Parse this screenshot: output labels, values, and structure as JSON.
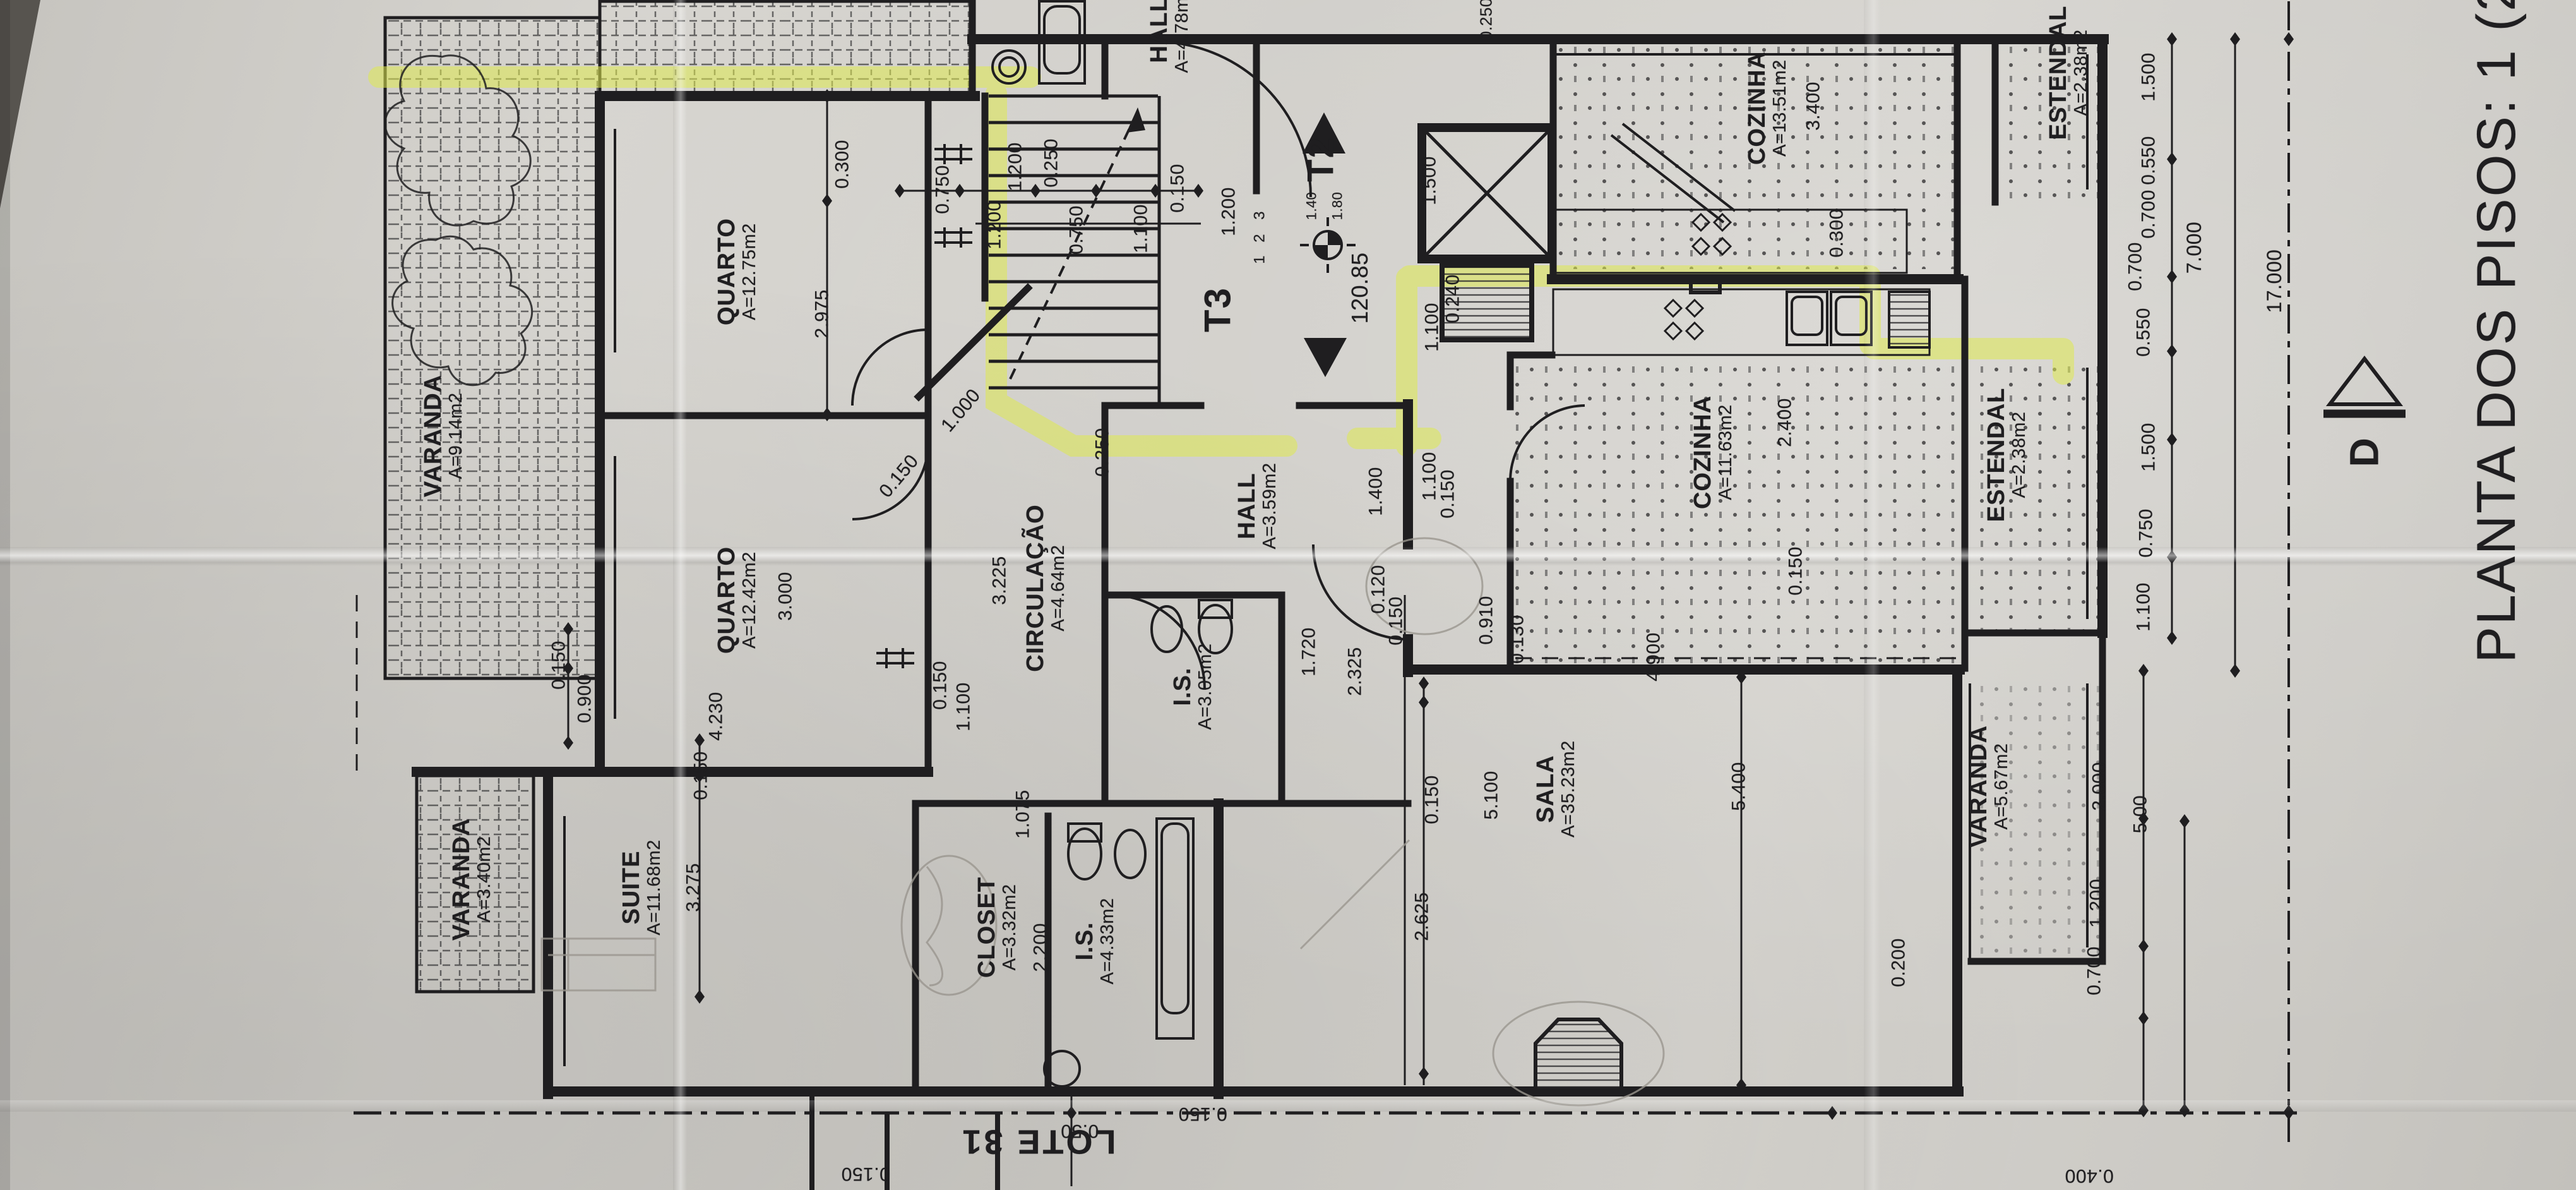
{
  "title": "PLANTA DOS PISOS: 1 (2, 3",
  "lot_label": "LOTE 31",
  "section_marker": "D",
  "levels": {
    "t2": "T2",
    "t3": "T3",
    "elevation": "120.85"
  },
  "stair_steps": [
    {
      "t": "3",
      "x": 48.9,
      "y": 18.1
    },
    {
      "t": "2",
      "x": 48.9,
      "y": 20.0
    },
    {
      "t": "1",
      "x": 48.9,
      "y": 21.8
    }
  ],
  "rooms": [
    {
      "n": "VARANDA",
      "a": "A=9.14m2",
      "x": 17.2,
      "y": 36.6
    },
    {
      "n": "QUARTO",
      "a": "A=12.75m2",
      "x": 28.6,
      "y": 22.8
    },
    {
      "n": "QUARTO",
      "a": "A=12.42m2",
      "x": 28.6,
      "y": 50.4
    },
    {
      "n": "CIRCULAÇÃO",
      "a": "A=4.64m2",
      "x": 40.6,
      "y": 49.4
    },
    {
      "n": "HALL",
      "a": "A=3.59m2",
      "x": 48.8,
      "y": 42.5
    },
    {
      "n": "HALL",
      "a": "A=4.78m2",
      "x": 45.4,
      "y": 2.5
    },
    {
      "n": "COZINHA",
      "a": "A=13.51m2",
      "x": 68.6,
      "y": 9.1
    },
    {
      "n": "COZINHA",
      "a": "A=11.63m2",
      "x": 66.5,
      "y": 38.0
    },
    {
      "n": "ESTENDAL",
      "a": "A=2.38m2",
      "x": 80.3,
      "y": 6.1
    },
    {
      "n": "ESTENDAL",
      "a": "A=2.38m2",
      "x": 77.9,
      "y": 38.2
    },
    {
      "n": "SALA",
      "a": "A=35.23m2",
      "x": 60.4,
      "y": 66.3
    },
    {
      "n": "VARANDA",
      "a": "A=5.67m2",
      "x": 77.2,
      "y": 66.1
    },
    {
      "n": "VARANDA",
      "a": "A=3.40m2",
      "x": 18.3,
      "y": 73.9
    },
    {
      "n": "SUITE",
      "a": "A=11.68m2",
      "x": 24.9,
      "y": 74.6
    },
    {
      "n": "CLOSET",
      "a": "A=3.32m2",
      "x": 38.7,
      "y": 77.9
    },
    {
      "n": "I.S.",
      "a": "A=4.33m2",
      "x": 42.5,
      "y": 79.1
    },
    {
      "n": "I.S.",
      "a": "A=3.05m2",
      "x": 46.3,
      "y": 57.7
    }
  ],
  "dims": [
    {
      "t": "0.300",
      "x": 32.7,
      "y": 13.8
    },
    {
      "t": "2.975",
      "x": 31.9,
      "y": 26.4
    },
    {
      "t": "0.750",
      "x": 36.6,
      "y": 15.9
    },
    {
      "t": "1.200",
      "x": 39.4,
      "y": 14.0
    },
    {
      "t": "0.250",
      "x": 40.8,
      "y": 13.7
    },
    {
      "t": "0.150",
      "x": 45.7,
      "y": 15.8
    },
    {
      "t": "1.200",
      "x": 47.7,
      "y": 17.8
    },
    {
      "t": "1.200",
      "x": 38.6,
      "y": 18.9
    },
    {
      "t": "0.750",
      "x": 41.8,
      "y": 19.3
    },
    {
      "t": "1.100",
      "x": 44.3,
      "y": 19.2
    },
    {
      "t": "1.500",
      "x": 55.5,
      "y": 15.2
    },
    {
      "t": "1.40",
      "x": 50.9,
      "y": 17.3,
      "s": 22
    },
    {
      "t": "1.80",
      "x": 51.9,
      "y": 17.3,
      "s": 22
    },
    {
      "t": "0.240",
      "x": 56.4,
      "y": 25.1
    },
    {
      "t": "1.100",
      "x": 55.6,
      "y": 27.5
    },
    {
      "t": "0.250",
      "x": 57.7,
      "y": 1.6,
      "s": 26
    },
    {
      "t": "3.400",
      "x": 70.4,
      "y": 8.9
    },
    {
      "t": "0.300",
      "x": 71.3,
      "y": 19.6
    },
    {
      "t": "2.400",
      "x": 69.3,
      "y": 35.5
    },
    {
      "t": "0.150",
      "x": 69.7,
      "y": 48.0
    },
    {
      "t": "4.900",
      "x": 64.2,
      "y": 55.2
    },
    {
      "t": "1.500",
      "x": 83.4,
      "y": 6.5
    },
    {
      "t": "0.550",
      "x": 83.4,
      "y": 13.5
    },
    {
      "t": "0.700",
      "x": 83.4,
      "y": 18.0
    },
    {
      "t": "0.700",
      "x": 82.9,
      "y": 22.4
    },
    {
      "t": "0.550",
      "x": 83.2,
      "y": 27.9
    },
    {
      "t": "7.000",
      "x": 85.2,
      "y": 20.8,
      "s": 32
    },
    {
      "t": "17.000",
      "x": 88.3,
      "y": 23.6,
      "s": 32
    },
    {
      "t": "1.500",
      "x": 83.4,
      "y": 37.6
    },
    {
      "t": "0.750",
      "x": 83.3,
      "y": 44.8
    },
    {
      "t": "1.100",
      "x": 83.2,
      "y": 51.0
    },
    {
      "t": "3.000",
      "x": 30.5,
      "y": 50.1
    },
    {
      "t": "4.230",
      "x": 27.8,
      "y": 60.2
    },
    {
      "t": "0.150",
      "x": 36.5,
      "y": 57.6
    },
    {
      "t": "1.100",
      "x": 37.4,
      "y": 59.4
    },
    {
      "t": "3.225",
      "x": 38.8,
      "y": 48.8
    },
    {
      "t": "1.000",
      "x": 37.3,
      "y": 34.5,
      "r": -50
    },
    {
      "t": "0.150",
      "x": 34.9,
      "y": 40.0,
      "r": -50
    },
    {
      "t": "0.250",
      "x": 42.8,
      "y": 38.0
    },
    {
      "t": "1.400",
      "x": 53.4,
      "y": 41.3
    },
    {
      "t": "1.100",
      "x": 55.5,
      "y": 40.0
    },
    {
      "t": "0.150",
      "x": 56.2,
      "y": 41.5
    },
    {
      "t": "0.120",
      "x": 53.5,
      "y": 49.5
    },
    {
      "t": "0.150",
      "x": 54.2,
      "y": 52.2
    },
    {
      "t": "0.910",
      "x": 57.7,
      "y": 52.1
    },
    {
      "t": "0.130",
      "x": 58.9,
      "y": 53.7
    },
    {
      "t": "1.720",
      "x": 50.8,
      "y": 54.8
    },
    {
      "t": "2.325",
      "x": 52.6,
      "y": 56.4
    },
    {
      "t": "2.625",
      "x": 55.2,
      "y": 77.0
    },
    {
      "t": "0.150",
      "x": 55.6,
      "y": 67.2
    },
    {
      "t": "5.100",
      "x": 57.9,
      "y": 66.8
    },
    {
      "t": "5.400",
      "x": 67.5,
      "y": 66.1
    },
    {
      "t": "0.150",
      "x": 27.2,
      "y": 65.2
    },
    {
      "t": "3.275",
      "x": 26.9,
      "y": 74.6
    },
    {
      "t": "1.075",
      "x": 39.7,
      "y": 68.4
    },
    {
      "t": "2.200",
      "x": 40.4,
      "y": 79.6
    },
    {
      "t": "0.150",
      "x": 21.7,
      "y": 55.9
    },
    {
      "t": "0.900",
      "x": 22.7,
      "y": 58.7
    },
    {
      "t": "2.000",
      "x": 81.5,
      "y": 66.1
    },
    {
      "t": "5.00",
      "x": 83.1,
      "y": 68.4
    },
    {
      "t": "1.200",
      "x": 81.4,
      "y": 75.9
    },
    {
      "t": "0.700",
      "x": 81.3,
      "y": 81.6
    },
    {
      "t": "0.200",
      "x": 73.7,
      "y": 80.9
    },
    {
      "t": "0.150",
      "x": 46.7,
      "y": 93.6,
      "r": 180
    },
    {
      "t": "0.50",
      "x": 41.9,
      "y": 95.0,
      "r": 180
    },
    {
      "t": "0.150",
      "x": 33.6,
      "y": 98.6,
      "r": 180
    },
    {
      "t": "0.400",
      "x": 81.1,
      "y": 98.8,
      "r": 180
    }
  ],
  "colors": {
    "paper": "#d1cfca",
    "ink": "#1f1e20",
    "highlight": "#dfe94f",
    "pencil": "#9a968f"
  }
}
